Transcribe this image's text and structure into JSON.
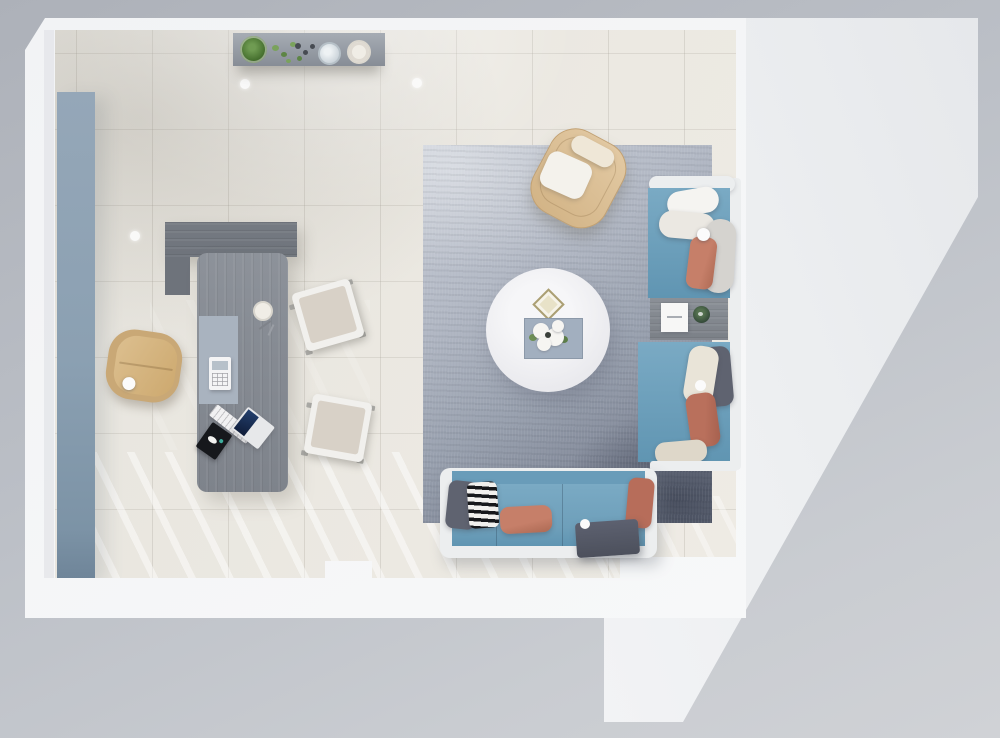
{
  "scene_type": "top-down 3d interior render, office lounge floor plan, no visible text",
  "zones": {
    "office": [
      "storage-panel",
      "console-shelf",
      "credenza",
      "executive-desk",
      "office-chair",
      "guest-chair-1",
      "guest-chair-2"
    ],
    "lounge": [
      "area-rug",
      "round-coffee-table",
      "accent-armchair",
      "sofa-right-upper",
      "corner-side-table",
      "sofa-right-lower",
      "sofa-bottom",
      "ottoman"
    ],
    "architecture": [
      "outer-background",
      "wall-frame",
      "room-floor",
      "terrace-floor",
      "ceiling-lights",
      "floor-light-stripes"
    ]
  },
  "objects": [
    {
      "id": "terrace-floor",
      "desc": "adjacent light area with long diagonal edge",
      "color_ref": "terrace_a"
    },
    {
      "id": "wall-frame",
      "desc": "white wall band around room with bottom notch",
      "color_ref": "wall"
    },
    {
      "id": "room-floor",
      "desc": "cream tiled floor with window light stripes",
      "color_ref": "floor_a"
    },
    {
      "id": "storage-panel",
      "desc": "slate blue wall cabinet, left wall",
      "color_ref": "panel_a"
    },
    {
      "id": "console-shelf",
      "desc": "gray shelf with potted plant, sprigs, berries, glass vase, cream dish",
      "color_ref": "shelf_wood"
    },
    {
      "id": "credenza",
      "desc": "dark gray wood return unit",
      "color_ref": "wood_dark"
    },
    {
      "id": "executive-desk",
      "desc": "gray wood desk with blue pad, phone, cup, pens, keyboard, laptop, black notebook",
      "color_ref": "wood_desk"
    },
    {
      "id": "office-chair",
      "desc": "tan swivel chair with white knob",
      "color_ref": "ochair_a"
    },
    {
      "id": "guest-chair-1",
      "desc": "white frame chair with greige cushion, tilted",
      "color_ref": "gchair_pad"
    },
    {
      "id": "guest-chair-2",
      "desc": "white frame chair with greige cushion, tilted",
      "color_ref": "gchair_pad"
    },
    {
      "id": "area-rug",
      "desc": "gradient gray-blue rug, dark lower-right corner",
      "color_ref": "rug_b"
    },
    {
      "id": "round-coffee-table",
      "desc": "white round table with diamond ornament and flower tray",
      "color_ref": "table_top"
    },
    {
      "id": "accent-armchair",
      "desc": "tan rounded armchair with cream headrest and white seat pillow",
      "color_ref": "armchair_a"
    },
    {
      "id": "sofa-right-upper",
      "desc": "blue seat, two white pillows, gray bolster, coral pillow, white ball",
      "color_ref": "sofa_blue_a"
    },
    {
      "id": "corner-side-table",
      "desc": "gray table with white card and green planter",
      "color_ref": "side_table_a"
    },
    {
      "id": "sofa-right-lower",
      "desc": "blue seat, gray/cream/coral/beige pillows, white ledge",
      "color_ref": "sofa_blue_a"
    },
    {
      "id": "sofa-bottom",
      "desc": "white frame sofa, blue cushions, gray + black-white striped + coral + rust pillows",
      "color_ref": "sofa_blue_a"
    },
    {
      "id": "ottoman",
      "desc": "dark gray cushion block with white ball",
      "color_ref": "ottoman"
    },
    {
      "id": "ceiling-lights",
      "desc": "three recessed white light dots on floor plan",
      "color_ref": "ball_white"
    }
  ],
  "palette": {
    "bg_top": "#adb1b9",
    "bg_mid": "#bbbfc6",
    "bg_bottom": "#c9ccd1",
    "terrace_a": "#e6e8eb",
    "terrace_b": "#edeff1",
    "wall": "#f2f3f5",
    "wall_line": "#e0e2e6",
    "floor_a": "#e6e4de",
    "floor_b": "#f0ede6",
    "panel_a": "#95a7b8",
    "panel_b": "#7c93a6",
    "shelf_wood": "#a6acb4",
    "wood_dark": "#6e737b",
    "wood_desk": "#868b93",
    "desk_pad": "#a9b3bf",
    "sofa_frame": "#eceeef",
    "sofa_blue_a": "#7aaac4",
    "sofa_blue_b": "#6095b2",
    "sofa_back": "#699cb9",
    "pillow_white": "#f5f4f1",
    "pillow_white2": "#ebe8e2",
    "pillow_cream": "#e9e4d8",
    "pillow_beige": "#ded7c9",
    "pillow_coral": "#c67f69",
    "pillow_coral2": "#b9705c",
    "pillow_rust": "#b76d5a",
    "pillow_gray": "#5f6370",
    "bolster_gray": "#d5d3cf",
    "ottoman": "#4c505c",
    "stripe_dark": "#17181b",
    "stripe_light": "#f1f0ed",
    "rug_a": "#c9ced7",
    "rug_b": "#98a0ae",
    "rug_c": "#6a7181",
    "table_top": "#f6f6f8",
    "tray": "#a2afbf",
    "flower_white": "#f6f5f2",
    "leaf_green": "#7aa25c",
    "plant_green_a": "#6f9b52",
    "plant_green_b": "#46702f",
    "berry_dark": "#474b52",
    "glass_blue": "#c7d0d7",
    "dish_cream": "#f0ede6",
    "armchair_a": "#e3caa4",
    "armchair_b": "#d2b385",
    "armchair_edge": "#c2a172",
    "headrest_cream": "#efe7d7",
    "seatpad_white": "#f4f2ec",
    "ochair_rim": "#c9a876",
    "ochair_a": "#dcbf8f",
    "ochair_b": "#cda96f",
    "gchair_frame": "#f1f0ed",
    "gchair_pad": "#d8d1c7",
    "side_table_a": "#8b9097",
    "side_table_b": "#7b8087",
    "card_white": "#f7f7f6",
    "planter_green": "#2f4336",
    "navy_a": "#24406e",
    "navy_b": "#0f1c38",
    "notebook_black": "#16181c",
    "metal_gray": "#9b9b99",
    "ball_white": "#fbfbfb"
  }
}
